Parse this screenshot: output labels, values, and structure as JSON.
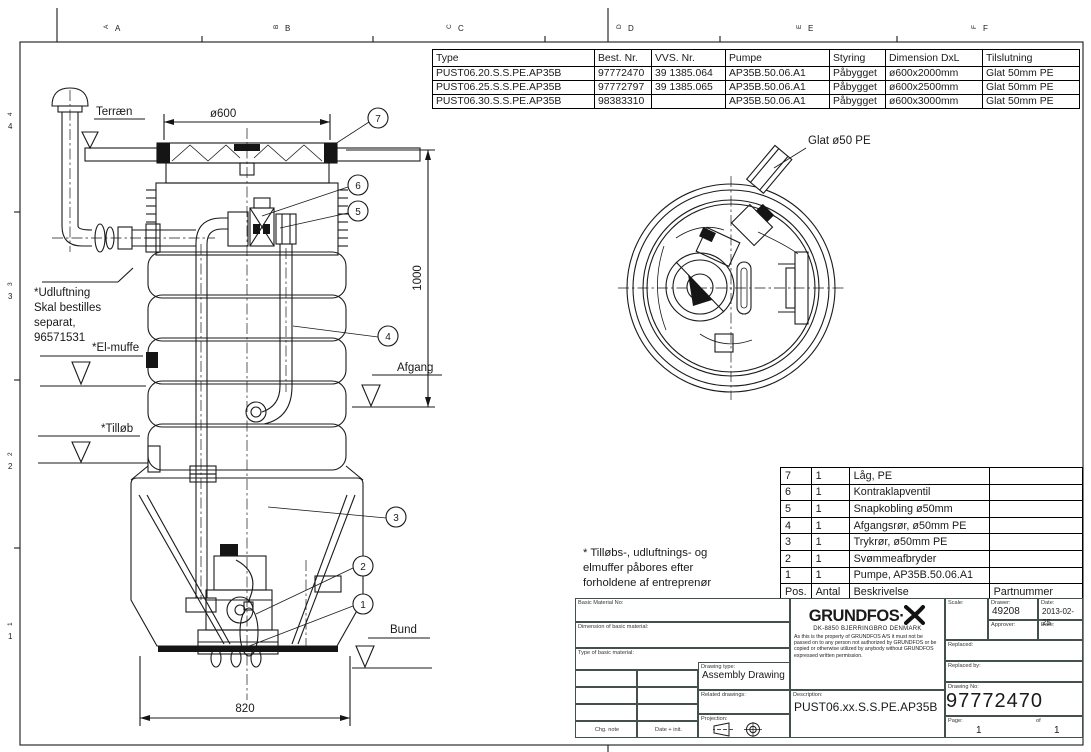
{
  "frame": {
    "top_letters": [
      "A",
      "B",
      "C",
      "D",
      "E",
      "F"
    ],
    "left_numbers": [
      "4",
      "3",
      "2",
      "1"
    ]
  },
  "spec_table": {
    "headers": [
      "Type",
      "Best. Nr.",
      "VVS. Nr.",
      "Pumpe",
      "Styring",
      "Dimension DxL",
      "Tilslutning"
    ],
    "rows": [
      [
        "PUST06.20.S.S.PE.AP35B",
        "97772470",
        "39 1385.064",
        "AP35B.50.06.A1",
        "Påbygget",
        "ø600x2000mm",
        "Glat 50mm PE"
      ],
      [
        "PUST06.25.S.S.PE.AP35B",
        "97772797",
        "39 1385.065",
        "AP35B.50.06.A1",
        "Påbygget",
        "ø600x2500mm",
        "Glat 50mm PE"
      ],
      [
        "PUST06.30.S.S.PE.AP35B",
        "98383310",
        "",
        "AP35B.50.06.A1",
        "Påbygget",
        "ø600x3000mm",
        "Glat 50mm PE"
      ]
    ]
  },
  "parts_table": {
    "headers": [
      "Pos.",
      "Antal",
      "Beskrivelse",
      "Partnummer"
    ],
    "rows": [
      [
        "7",
        "1",
        "Låg, PE",
        ""
      ],
      [
        "6",
        "1",
        "Kontraklapventil",
        ""
      ],
      [
        "5",
        "1",
        "Snapkobling ø50mm",
        ""
      ],
      [
        "4",
        "1",
        "Afgangsrør, ø50mm PE",
        ""
      ],
      [
        "3",
        "1",
        "Trykrør, ø50mm PE",
        ""
      ],
      [
        "2",
        "1",
        "Svømmeafbryder",
        ""
      ],
      [
        "1",
        "1",
        "Pumpe, AP35B.50.06.A1",
        ""
      ]
    ]
  },
  "elevation": {
    "labels": {
      "terraen": "Terræn",
      "udluftning_lines": [
        "*Udluftning",
        "Skal bestilles",
        "separat,",
        "96571531"
      ],
      "elmuffe": "*El-muffe",
      "tilloeb": "*Tilløb",
      "afgang": "Afgang",
      "bund": "Bund"
    },
    "dimensions": {
      "diameter": "ø600",
      "height": "1000",
      "width": "820"
    },
    "callouts": [
      "1",
      "2",
      "3",
      "4",
      "5",
      "6",
      "7"
    ]
  },
  "plan": {
    "label": "Glat ø50 PE"
  },
  "note": {
    "line1": "* Tilløbs-, udluftnings- og",
    "line2": "elmuffer påbores efter",
    "line3": "forholdene af entreprenør"
  },
  "title_block": {
    "basic_material_no": "Basic Material No:",
    "dimension_basic": "Dimension of basic material:",
    "type_basic": "Type of basic material:",
    "chg_note": "Chg. note",
    "date_init": "Date + init.",
    "drawing_type_label": "Drawing type:",
    "drawing_type": "Assembly Drawing",
    "related_label": "Related drawings:",
    "projection_label": "Projection:",
    "company": "GRUNDFOS·",
    "address": "DK-8850 BJERRINGBRO DENMARK",
    "legal": "As this is the property of GRUNDFOS A/S it must not be passed on to any person not authorized by GRUNDFOS or be copied or otherwise utilized by anybody without GRUNDFOS expressed written permission.",
    "description_label": "Description:",
    "description": "PUST06.xx.S.S.PE.AP35B",
    "scale_label": "Scale:",
    "drawer_label": "Drawer:",
    "drawer": "49208",
    "date_label": "Date:",
    "date": "2013-02-25",
    "approver_label": "Approver:",
    "approver_date_label": "Date:",
    "replaced_label": "Replaced:",
    "replaced_by_label": "Replaced by:",
    "drawing_no_label": "Drawing No:",
    "drawing_no": "97772470",
    "page_label": "Page:",
    "page": "1",
    "of_label": "of",
    "page_total": "1"
  }
}
